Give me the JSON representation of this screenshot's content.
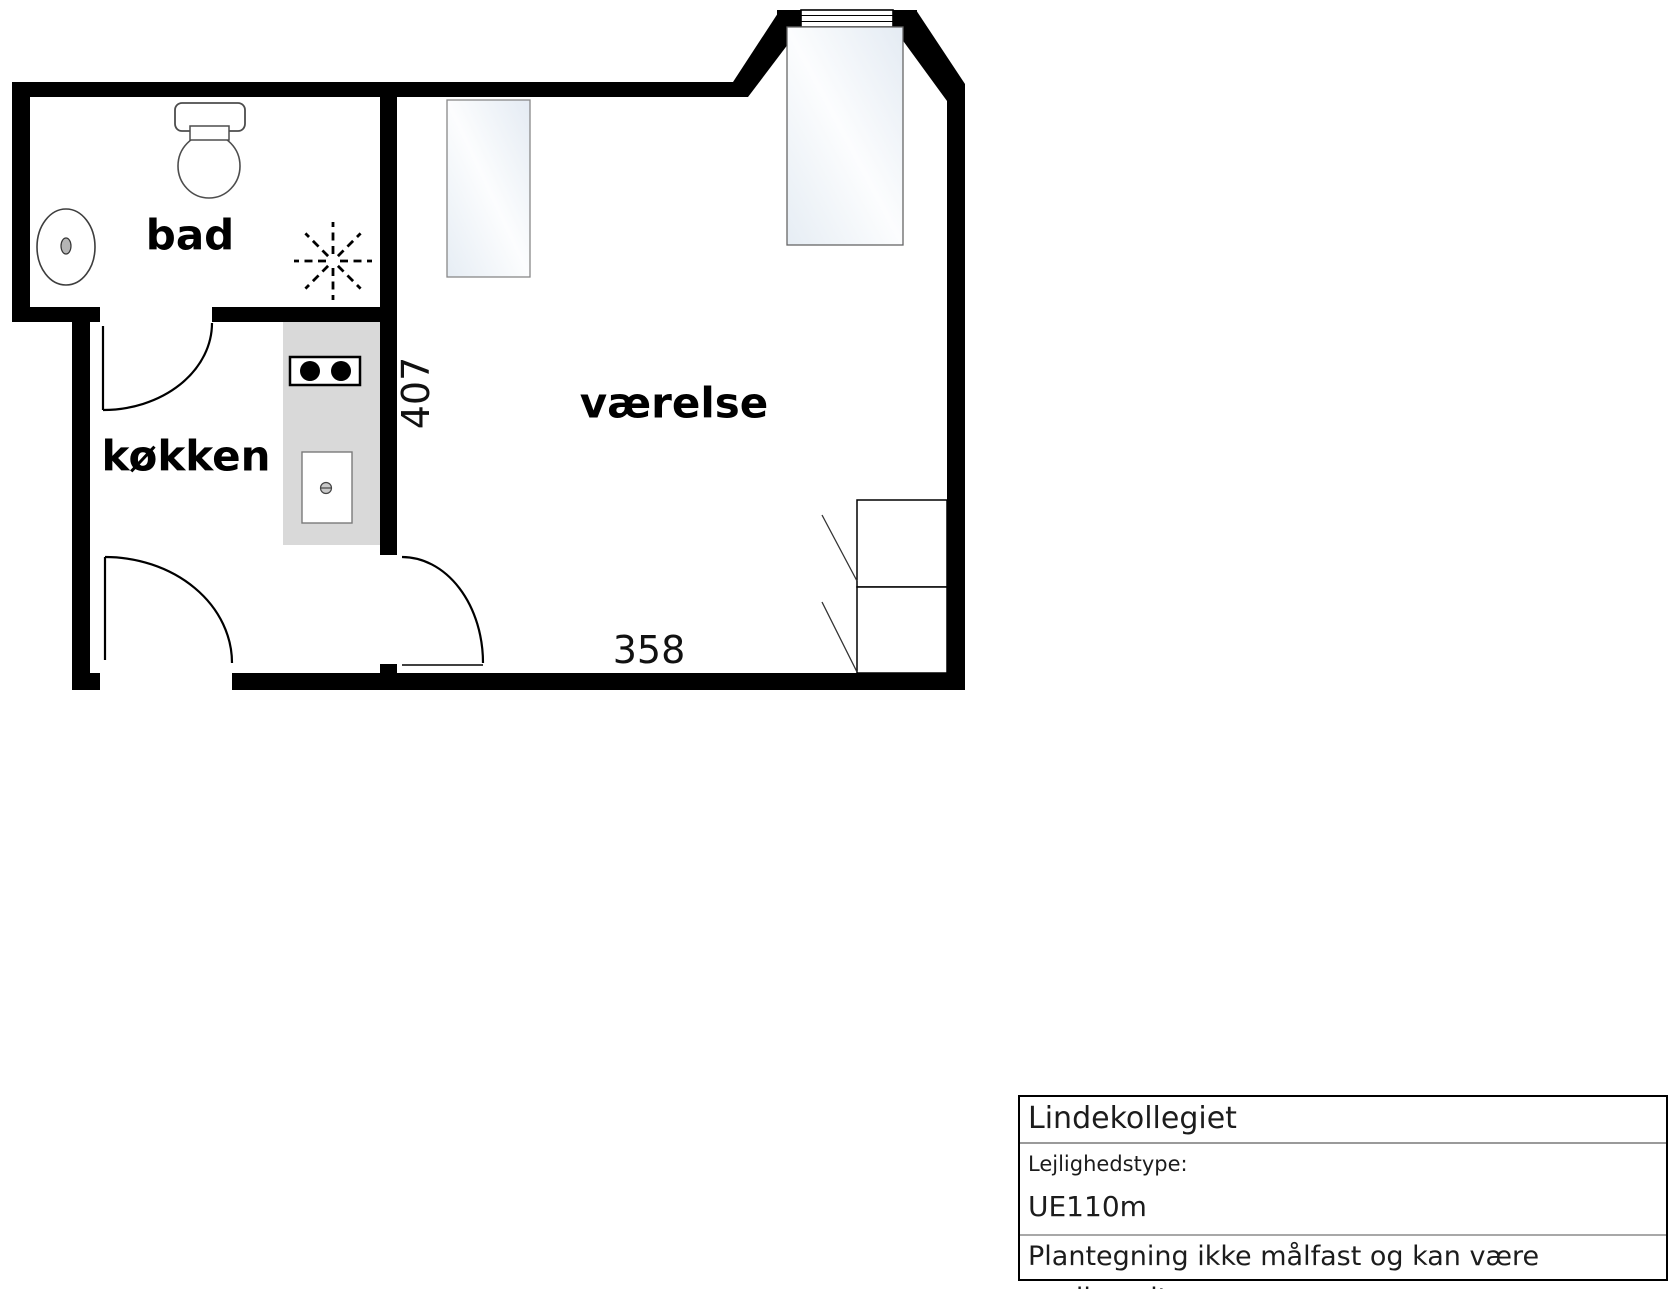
{
  "floorplan": {
    "labels": {
      "bathroom": "bad",
      "kitchen": "køkken",
      "room": "værelse"
    },
    "dimensions": {
      "width_cm": "358",
      "height_cm": "407"
    },
    "colors": {
      "wall": "#000000",
      "counter": "#d9d9d9",
      "furniture_border": "#777777",
      "furniture_fill_edge": "#e4ebf3",
      "furniture_fill_center": "#fcfdfe"
    },
    "icons": [
      "toilet-icon",
      "bathroom-sink-icon",
      "shower-drain-icon",
      "stove-icon",
      "kitchen-sink-icon",
      "window-icon",
      "bed",
      "desk",
      "wardrobe",
      "door-arc"
    ]
  },
  "title_block": {
    "title": "Lindekollegiet",
    "type_label": "Lejlighedstype:",
    "type_value": "UE110m",
    "disclaimer": "Plantegning ikke målfast og kan være spejlvendt."
  }
}
